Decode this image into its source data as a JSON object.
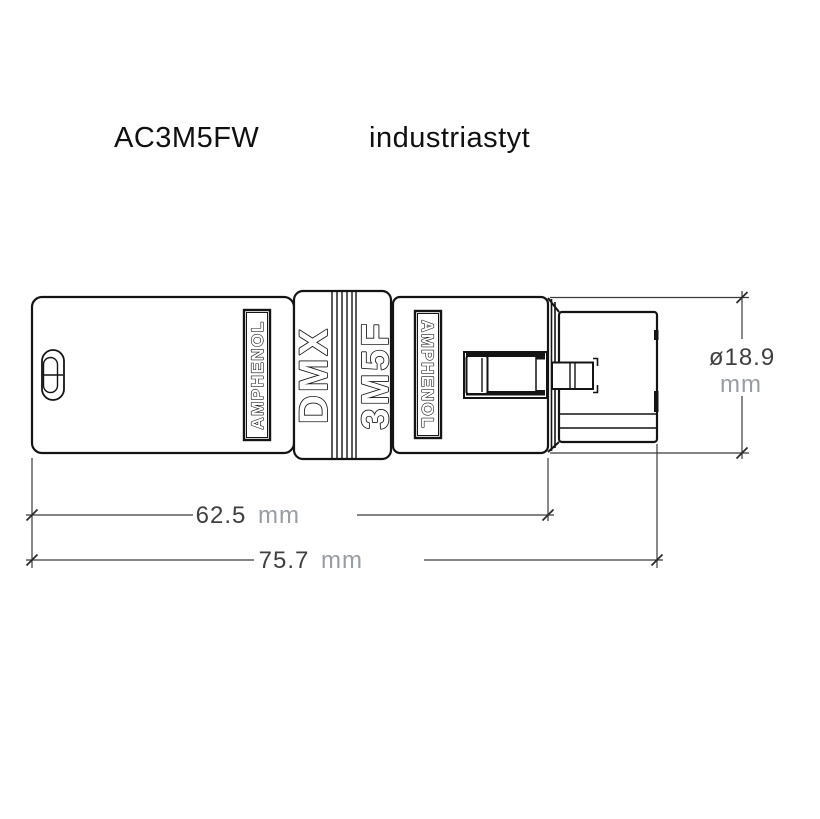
{
  "header": {
    "model": "AC3M5FW",
    "style_label": "industriastyt"
  },
  "connector": {
    "brand": "AMPHENOL",
    "marking_dmx": "DMX",
    "marking_type": "3M5F"
  },
  "dimensions": {
    "body_length": {
      "value": "62.5",
      "unit": "mm"
    },
    "total_length": {
      "value": "75.7",
      "unit": "mm"
    },
    "diameter": {
      "value": "ø18.9",
      "unit": "mm"
    }
  },
  "colors": {
    "line": "#141414",
    "dimension_value": "#3f3f3f",
    "dimension_unit": "#989ca3",
    "background": "#ffffff"
  }
}
